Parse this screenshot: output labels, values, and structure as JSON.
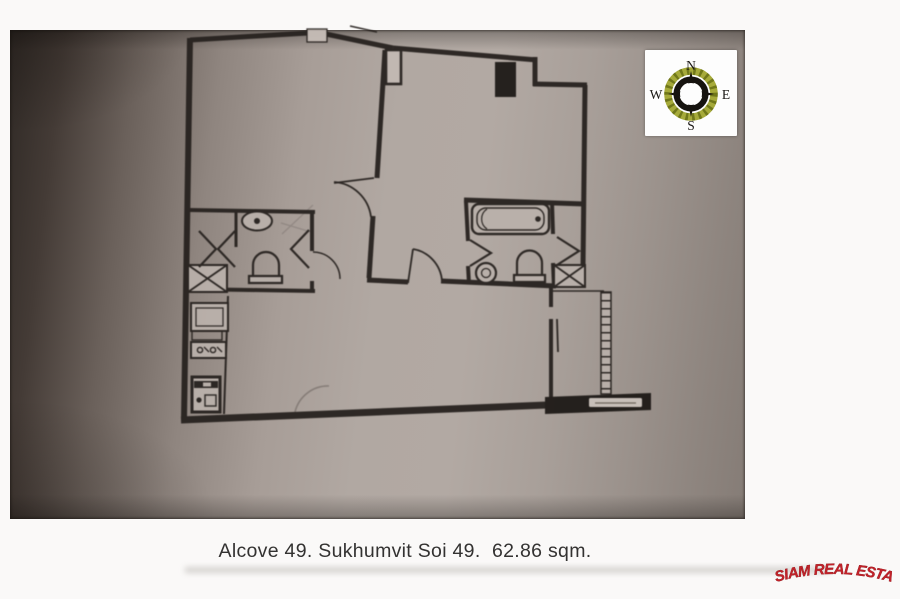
{
  "caption": {
    "text": "Alcove 49. Sukhumvit Soi 49.  62.86 sqm."
  },
  "listing": {
    "project": "Alcove 49",
    "street": "Sukhumvit Soi 49",
    "area": "62.86 sqm."
  },
  "compass": {
    "n": "N",
    "e": "E",
    "s": "S",
    "w": "W"
  },
  "watermark": {
    "text": "SIAM REAL ESTATE",
    "color": "#c3222a"
  },
  "colors": {
    "paper_light": "#b2a9a3",
    "paper_dark": "#2f2925",
    "wall": "#27221f",
    "compass_wreath": "#a6aa3a",
    "logo_red": "#c3222a"
  },
  "floor_plan": {
    "stroke": "#27221f",
    "fixture_fill": "#bab1ab",
    "elements": [
      {
        "t": "l",
        "a": [
          190,
          40,
          308,
          33
        ],
        "w": 5
      },
      {
        "t": "l",
        "a": [
          326,
          34,
          393,
          48
        ],
        "w": 5
      },
      {
        "t": "l",
        "a": [
          393,
          48,
          537,
          60
        ],
        "w": 5
      },
      {
        "t": "l",
        "a": [
          535,
          57,
          535,
          86
        ],
        "w": 5
      },
      {
        "t": "l",
        "a": [
          533,
          84,
          587,
          85
        ],
        "w": 5
      },
      {
        "t": "l",
        "a": [
          585,
          85,
          583,
          268
        ],
        "w": 5
      },
      {
        "t": "l",
        "a": [
          190,
          38,
          184,
          419
        ],
        "w": 6
      },
      {
        "t": "l",
        "a": [
          181,
          420,
          547,
          405
        ],
        "w": 7
      },
      {
        "t": "l",
        "a": [
          385,
          50,
          377,
          178
        ],
        "w": 5
      },
      {
        "t": "l",
        "a": [
          373,
          216,
          369,
          278
        ],
        "w": 5
      },
      {
        "t": "l",
        "a": [
          367,
          280,
          408,
          282
        ],
        "w": 5
      },
      {
        "t": "l",
        "a": [
          441,
          281,
          556,
          286
        ],
        "w": 5
      },
      {
        "t": "l",
        "a": [
          464,
          200,
          585,
          204
        ],
        "w": 5
      },
      {
        "t": "l",
        "a": [
          466,
          202,
          468,
          241
        ],
        "w": 4
      },
      {
        "t": "l",
        "a": [
          468,
          266,
          469,
          284
        ],
        "w": 4
      },
      {
        "t": "l",
        "a": [
          552,
          202,
          553,
          234
        ],
        "w": 4
      },
      {
        "t": "l",
        "a": [
          553,
          263,
          554,
          287
        ],
        "w": 4
      },
      {
        "t": "l",
        "a": [
          551,
          287,
          551,
          307
        ],
        "w": 4
      },
      {
        "t": "l",
        "a": [
          551,
          319,
          551,
          398
        ],
        "w": 4
      },
      {
        "t": "l",
        "a": [
          189,
          210,
          315,
          212
        ],
        "w": 4
      },
      {
        "t": "l",
        "a": [
          312,
          212,
          312,
          251
        ],
        "w": 4
      },
      {
        "t": "l",
        "a": [
          312,
          281,
          312,
          291
        ],
        "w": 4
      },
      {
        "t": "l",
        "a": [
          187,
          289,
          315,
          291
        ],
        "w": 4
      },
      {
        "t": "l",
        "a": [
          236,
          212,
          236,
          247
        ],
        "w": 3
      },
      {
        "t": "l",
        "a": [
          553,
          291,
          604,
          291
        ],
        "w": 1.5
      },
      {
        "t": "l",
        "a": [
          228,
          296,
          224,
          414
        ],
        "w": 2
      },
      {
        "t": "l",
        "a": [
          557,
          319,
          558,
          352
        ],
        "w": 1.8
      },
      {
        "t": "l",
        "a": [
          350,
          26,
          377,
          32
        ],
        "w": 1.5
      },
      {
        "t": "r",
        "a": [
          601,
          292,
          10,
          102
        ],
        "f": "#b9b0aa",
        "sw": 1.5
      },
      {
        "t": "l",
        "a": [
          606,
          292,
          606,
          394
        ],
        "w": 9,
        "da": "1.5 6.5"
      },
      {
        "t": "p",
        "d": "M545,397 L651,393 L651,410 L545,414 Z",
        "f": "#1e1a17",
        "w": 0
      },
      {
        "t": "r",
        "a": [
          589,
          398,
          53,
          9
        ],
        "f": "#cac2bc",
        "r": 1.5,
        "sw": 0
      },
      {
        "t": "l",
        "a": [
          595,
          403,
          636,
          403
        ],
        "w": 1.2,
        "c": "#6b6259"
      },
      {
        "t": "r",
        "a": [
          307,
          29,
          20,
          13
        ],
        "f": "#c6bdb7",
        "sw": 1.3
      },
      {
        "t": "r",
        "a": [
          386,
          50,
          15,
          34
        ],
        "f": "#c2b9b3",
        "sw": 2.6
      },
      {
        "t": "r",
        "a": [
          495,
          62,
          21,
          35
        ],
        "f": "#1e1a17",
        "sw": 0
      },
      {
        "t": "x",
        "a": [
          188,
          265,
          39,
          27
        ],
        "f": "#b9b0aa"
      },
      {
        "t": "x",
        "a": [
          554,
          265,
          31,
          22
        ],
        "f": "#b9b0aa"
      },
      {
        "t": "e",
        "a": [
          257,
          221,
          15,
          9.5
        ],
        "sw": 2,
        "f": "#bab1ab"
      },
      {
        "t": "c",
        "a": [
          257,
          221,
          3
        ],
        "f": "#27221f",
        "sw": 0
      },
      {
        "t": "r",
        "a": [
          249,
          276,
          33,
          7
        ],
        "sw": 2.2,
        "f": "#bab1ab"
      },
      {
        "t": "p",
        "d": "M253,276 L253,265 A13,13 0 0 1 279,265 L279,276",
        "w": 2.2
      },
      {
        "t": "p",
        "d": "M199,231 L216,249 L199,267",
        "w": 2.2
      },
      {
        "t": "p",
        "d": "M235,231 L218,249 L235,267",
        "w": 2.2
      },
      {
        "t": "p",
        "d": "M309,230 L291,249 L309,268",
        "w": 2.2
      },
      {
        "t": "p",
        "d": "M313,252 A27,27 0 0 1 340,279",
        "w": 1.5
      },
      {
        "t": "p",
        "d": "M334,182 A40,40 0 0 1 371,217",
        "w": 1.8
      },
      {
        "t": "l",
        "a": [
          374,
          178,
          334,
          183
        ],
        "w": 1.8
      },
      {
        "t": "l",
        "a": [
          408,
          283,
          413,
          249
        ],
        "w": 1.8
      },
      {
        "t": "p",
        "d": "M413,249 A35,35 0 0 1 442,281",
        "w": 1.8
      },
      {
        "t": "r",
        "a": [
          472,
          204,
          77,
          30
        ],
        "r": 7,
        "sw": 2.4,
        "f": "#bab1ab"
      },
      {
        "t": "r",
        "a": [
          477,
          208,
          67,
          22
        ],
        "r": 9,
        "sw": 1.4
      },
      {
        "t": "p",
        "d": "M487,209 A12,12 0 0 0 487,229",
        "w": 1.2
      },
      {
        "t": "c",
        "a": [
          538,
          219,
          2.8
        ],
        "f": "#27221f",
        "sw": 0
      },
      {
        "t": "r",
        "a": [
          514,
          275,
          31,
          7
        ],
        "sw": 2.2,
        "f": "#bab1ab"
      },
      {
        "t": "p",
        "d": "M517,275 L517,263 A12.5,12.5 0 0 1 542,263 L542,275",
        "w": 2.2
      },
      {
        "t": "c",
        "a": [
          486,
          273,
          10
        ],
        "sw": 2.2,
        "f": "#bab1ab"
      },
      {
        "t": "c",
        "a": [
          486,
          273,
          4.5
        ],
        "sw": 1.3
      },
      {
        "t": "p",
        "d": "M470,240 L491,253 L470,266",
        "w": 2.2
      },
      {
        "t": "p",
        "d": "M557,237 L579,251 L557,265",
        "w": 2.2
      },
      {
        "t": "r",
        "a": [
          191,
          303,
          37,
          28
        ],
        "sw": 2,
        "f": "#bab1ab"
      },
      {
        "t": "r",
        "a": [
          196,
          308,
          27,
          18
        ],
        "sw": 1.2
      },
      {
        "t": "r",
        "a": [
          192,
          331,
          30,
          9
        ],
        "sw": 1.4
      },
      {
        "t": "r",
        "a": [
          191,
          342,
          35,
          16
        ],
        "sw": 2,
        "f": "#bab1ab"
      },
      {
        "t": "c",
        "a": [
          200,
          350,
          2.6
        ],
        "sw": 1.4
      },
      {
        "t": "c",
        "a": [
          213,
          350,
          2.6
        ],
        "sw": 1.4
      },
      {
        "t": "p",
        "d": "M204,347 L209,352 M217,347 L222,352",
        "w": 1.3
      },
      {
        "t": "r",
        "a": [
          192,
          377,
          28,
          35
        ],
        "sw": 3,
        "f": "#bab1ab"
      },
      {
        "t": "r",
        "a": [
          194,
          381,
          24,
          7
        ],
        "f": "#27221f",
        "sw": 0
      },
      {
        "t": "r",
        "a": [
          203,
          382.5,
          8,
          4
        ],
        "f": "#bab1ab",
        "sw": 0
      },
      {
        "t": "c",
        "a": [
          199,
          400,
          2.6
        ],
        "f": "#27221f",
        "sw": 0
      },
      {
        "t": "r",
        "a": [
          205,
          395,
          11,
          11
        ],
        "sw": 1.4
      },
      {
        "t": "p",
        "d": "M295,412 A34,34 0 0 1 329,386",
        "w": 1.6,
        "o": 0.3
      },
      {
        "t": "p",
        "d": "M282,234 L313,205 M281,223 L311,232",
        "w": 1.2,
        "o": 0.18
      }
    ]
  }
}
